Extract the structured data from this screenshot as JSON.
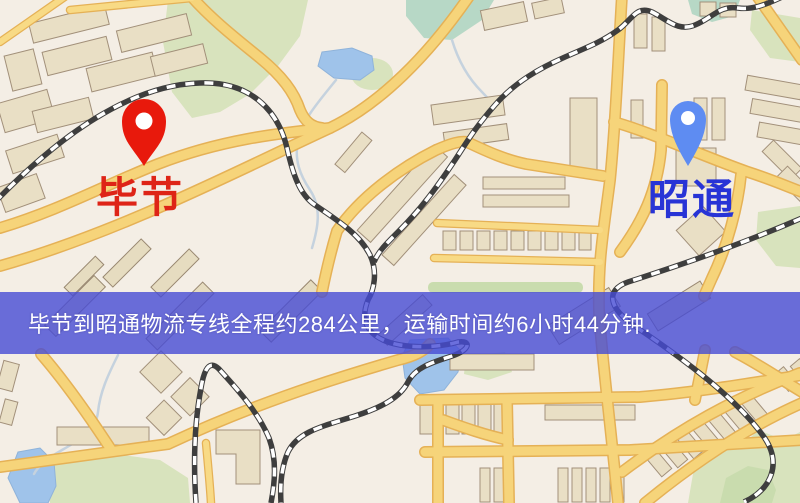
{
  "type": "map_route_graphic",
  "banner": {
    "text": "毕节到昭通物流专线全程约284公里，运输时间约6小时44分钟.",
    "distance_text": "284公里",
    "duration_text": "6小时44分钟",
    "bg_color": "rgba(70,75,213,0.80)",
    "text_color": "#FFFFFF"
  },
  "markers": {
    "origin": {
      "label": "毕节",
      "pin_color": "#E8190C",
      "pin_hole_color": "#FFFFFF",
      "label_color": "#DE2417"
    },
    "destination": {
      "label": "昭通",
      "pin_color": "#5E8CF2",
      "pin_hole_color": "#FFFFFF",
      "label_color": "#2834D6"
    }
  },
  "map_palette": {
    "background": "#F4EEE5",
    "road_fill": "#F6D47A",
    "road_casing": "#E5B156",
    "building": "#E9DFC5",
    "park_green": "#D8E3BD",
    "water_blue": "#9FC3EA",
    "railway_dark": "#3E3E3E"
  }
}
